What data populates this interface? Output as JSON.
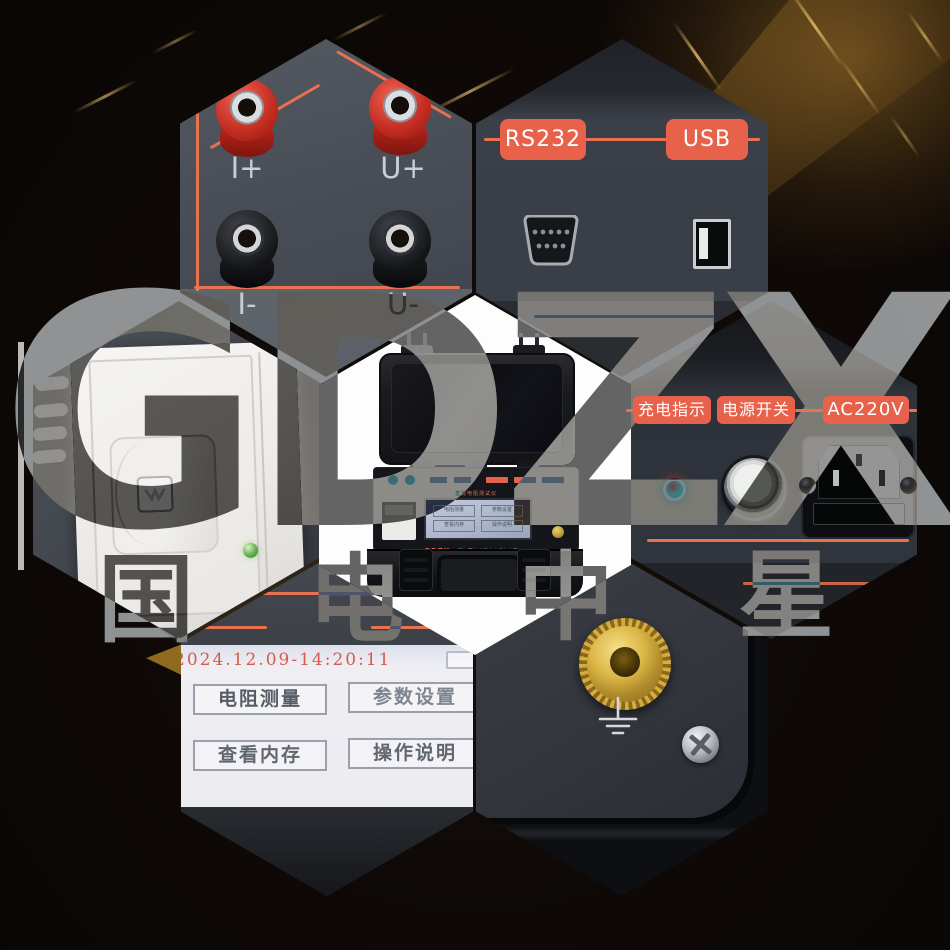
{
  "watermark": {
    "brand": "GDZX",
    "chars": [
      "国",
      "电",
      "中",
      "星"
    ]
  },
  "hex_terminals": {
    "pos_current": "I+",
    "pos_voltage": "U+",
    "neg_current": "I-",
    "neg_voltage": "U-"
  },
  "hex_ports": {
    "rs232": "RS232",
    "usb": "USB"
  },
  "hex_power": {
    "charge_indicator": "充电指示",
    "power_switch": "电源开关",
    "ac_input": "AC220V"
  },
  "hex_screen": {
    "timestamp": "2024.12.09-14:20:11",
    "menu": [
      "电阻测量",
      "参数设置",
      "查看内存",
      "操作说明"
    ]
  },
  "hex_device": {
    "title": "直流电阻测试仪",
    "brand": "GDZX",
    "company": "武汉国电中星电力设备有限公司"
  },
  "colors": {
    "accent": "#e8614b",
    "timestamp": "#d65a4f",
    "brass": "#c9a22e",
    "led_red": "#e23430",
    "led_green": "#62b04f"
  }
}
